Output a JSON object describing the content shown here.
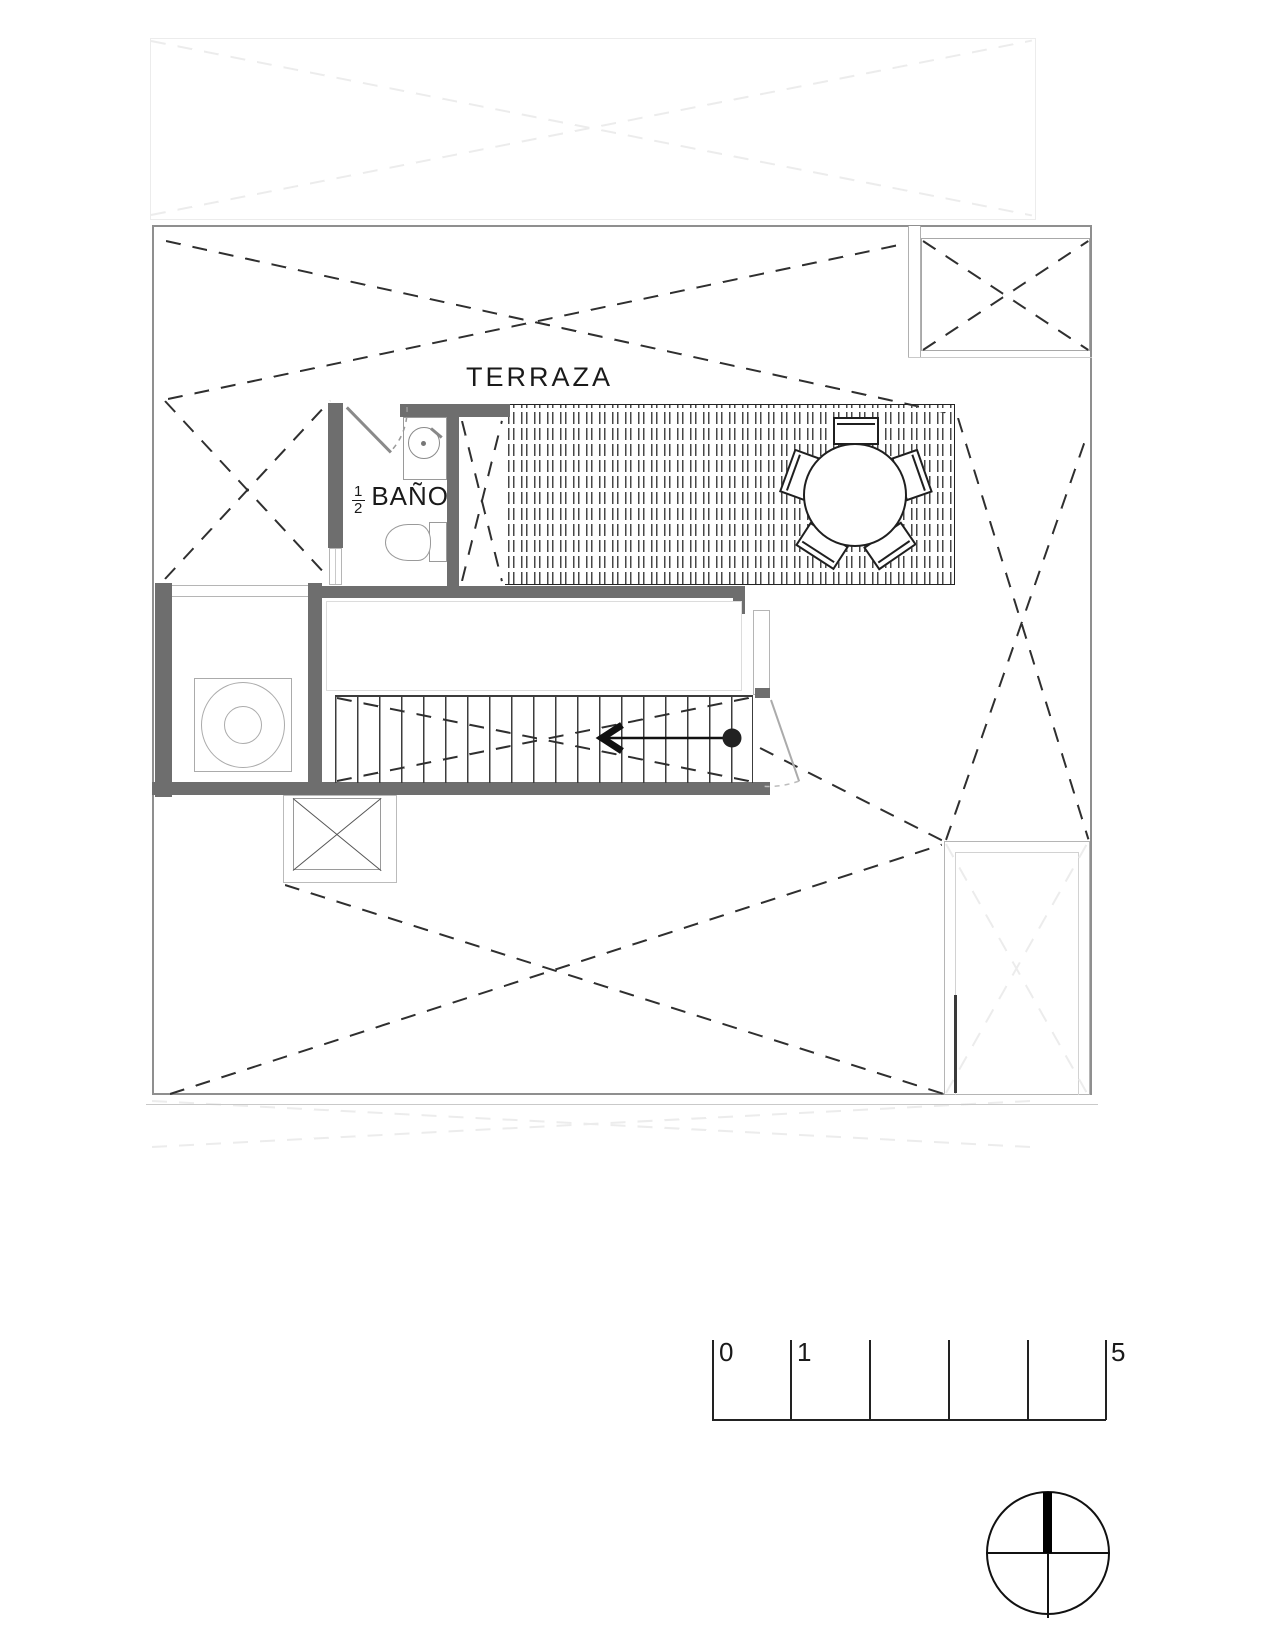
{
  "plan": {
    "terrace_label": "TERRAZA",
    "half_bath_label": {
      "numerator": "1",
      "denominator": "2",
      "text": "BAÑO"
    }
  },
  "scale_bar": {
    "tick_labels": [
      "0",
      "1",
      "5"
    ],
    "tick_count": 6
  },
  "symbols": {
    "north_indicator": "compass-north-icon",
    "stair_direction": "arrow-left-icon",
    "dining_set": "round-table-with-five-chairs",
    "bath_fixtures": [
      "sink",
      "toilet"
    ],
    "utility_fixture": "round-appliance-top-view",
    "roof_markers": "dashed-x-open-to-below"
  },
  "colors": {
    "wall": "#6e6e6e",
    "line_dark": "#2f2f2f",
    "line_mid": "#555555",
    "line_light": "#9a9a9a",
    "faint": "#ececec",
    "paper": "#ffffff",
    "ink": "#1a1a1a"
  }
}
